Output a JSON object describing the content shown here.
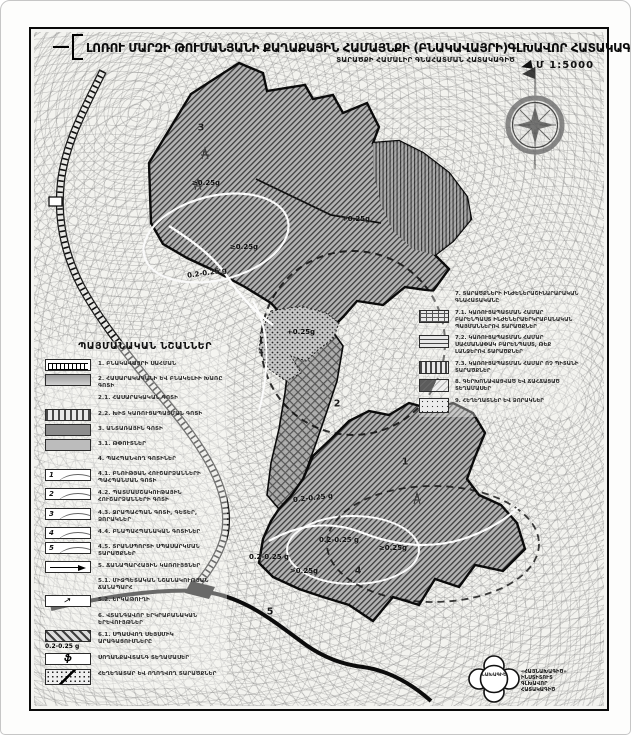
{
  "document": {
    "title": "ԼՈՌՈՒ ՄԱՐԶԻ ԹՈՒՄԱՆՅԱՆԻ ՔԱՂԱՔԱՅԻՆ ՀԱՄԱՅՆՔԻ (ԲՆԱԿԱՎԱՅՐԻ)ԳԼԽԱՎՈՐ ՀԱՏԱԿԱԳԻԾ",
    "subtitle": "ՏԱՐԱԾՔԻ ՀԱՄԱԼԻՐ ԳՆԱՀԱՏՄԱՆ ՀԱՏԱԿԱԳԻԾ",
    "scale_label": "Մ 1:5000"
  },
  "legend": {
    "title": "ՊԱՅՄԱՆԱԿԱՆ ՆՇԱՆՆԵՐ",
    "items": [
      {
        "label": "1. ԲՆԱԿԱՎԱՅՐԻ ՍԱՀՄԱՆ"
      },
      {
        "label": "2. ՀԱՍԱՐԱԿԱԿԱՆԻ ԵՎ ԲՆԱԿԵԼԻԻ ԽԱՌԸ ԳՈՏԻ"
      },
      {
        "label": "2.1. ՀԱՍԱՐԱԿԱԿԱՆ ԳՈՏԻ"
      },
      {
        "label": "2.2. ԽԻՏ ԿԱՌՈՒՑԱՊԱՏՄԱՆ ԳՈՏԻ"
      },
      {
        "label": "3. ԱՆՏԱՌԱՅԻՆ ԳՈՏԻ"
      },
      {
        "label": "3.1. ԹՓՈՒՏՆԵՐ"
      },
      {
        "label": "4. ՊԱՀՊԱՆՎՈՂ ԳՈՏԻՆԵՐ"
      },
      {
        "box": "1",
        "label": "4.1. ԲՆՈՒԹՅԱՆ ՀՈՒՇԱՐՁԱՆՆԵՐԻ ՊԱՀՊԱՆՄԱՆ ԳՈՏԻ"
      },
      {
        "box": "2",
        "label": "4.2. ՊԱՏՄԱՄՇԱԿՈՒԹԱՅԻՆ ՀՈՒՇԱՐՁԱՆՆԵՐԻ ԳՈՏԻ"
      },
      {
        "box": "3",
        "label": "4.3. ՋՐԱՊԱՀՊԱՆ ԳՈՏԻ, ԳԵՏԵՐ, ՁՈՐԱԿՆԵՐ"
      },
      {
        "box": "4",
        "label": "4.4. ԲՆԱՊԱՀՊԱՆԱԿԱՆ ԳՈՏԻՆԵՐ"
      },
      {
        "box": "5",
        "label": "4.5. ՏՐԱՆՍՊՈՐՏԻ ՍՊԱՍԱՐԿՄԱՆ ՏԱՐԱԾՔՆԵՐ"
      },
      {
        "label": "5. ՃԱՆԱՊԱՐՀԱՅԻՆ ԿԱՌՈՒՅՑՆԵՐ"
      },
      {
        "label": "5.1. ՄԻՋՊԵՏԱԿԱՆ ՆՇԱՆԱԿՈՒԹՅԱՆ ՃԱՆԱՊԱՐՀ"
      },
      {
        "label": "5.2. ԵՐԿԱԹՈՒՂԻ"
      },
      {
        "label": "6. ՎՏԱՆԳԱՎՈՐ ԵՐԿՐԱԲԱՆԱԿԱՆ ԵՐԵՎՈՒՅԹՆԵՐ"
      },
      {
        "label": "6.1. ՍՊԱՍՎՈՂ ՍԵՅՍՄԻԿ ԱՐԱԳԱՑՈՒՄՆԵՐԸ",
        "caption": "0.2-0.25 g"
      },
      {
        "box": "ֆ",
        "label": "ՍՈՂԱՆՔԱՎՏԱՆԳ ՏԵՂԱՄԱՍԵՐ"
      },
      {
        "label": "ՀԵՂԵՂԱՏԱՐ ԵՎ ՈՂՈՂՎՈՂ ՏԱՐԱԾՔՆԵՐ"
      }
    ]
  },
  "right_panel": {
    "items": [
      {
        "label": "7. ՏԱՐԱԾՔՆԵՐԻ ԻՆԺԵՆԵՐԱՇԻՆԱՐԱՐԱԿԱՆ ԳՆԱՀԱՏԱԿԱՆԸ"
      },
      {
        "label": "7.1. ԿԱՌՈՒՑԱՊԱՏՄԱՆ ՀԱՄԱՐ ԲԱՐԵՆՊԱՍՏ ԻՆԺԵՆԵՐԱԵՐԿՐԱԲԱՆԱԿԱՆ ՊԱՅՄԱՆՆԵՐՈՎ ՏԱՐԱԾՔՆԵՐ"
      },
      {
        "label": "7.2. ԿԱՌՈՒՑԱՊԱՏՄԱՆ ՀԱՄԱՐ ՍԱՀՄԱՆԱՓԱԿ ԲԱՐԵՆՊԱՍՏ, ԹԵՔ ԼԱՆՋԵՐՈՎ ՏԱՐԱԾՔՆԵՐ"
      },
      {
        "label": "7.3. ԿԱՌՈՒՑԱՊԱՏՄԱՆ ՀԱՄԱՐ ՈՉ ՊԻՏԱՆԻ ՏԱՐԱԾՔՆԵՐ"
      },
      {
        "label": "8. ԳԵՐԽՈՆԱՎԱՑՎԱԾ ԵՎ ՃԱՀՃԱՑԱԾ ՏԵՂԱՄԱՍԵՐ"
      },
      {
        "label": "9. ՀԵՂԵՂԱՏՆԵՐ ԵՎ ՁՈՐԱԿՆԵՐ"
      }
    ]
  },
  "map": {
    "labels": [
      {
        "text": "≥0.25g"
      },
      {
        "text": "+0.25g"
      },
      {
        "text": "≥0.25g"
      },
      {
        "text": "0.2-0.25 g"
      },
      {
        "text": "+0.25g"
      },
      {
        "text": "0.2-0.25 g"
      },
      {
        "text": "0.2-0.25 g"
      },
      {
        "text": "≥0.25g"
      },
      {
        "text": "0.2-0.25 g"
      },
      {
        "text": ">0.25g"
      }
    ],
    "zones": [
      {
        "num": "1"
      },
      {
        "num": "2"
      },
      {
        "num": "3"
      },
      {
        "num": "4"
      },
      {
        "num": "5"
      }
    ]
  },
  "stamp": {
    "center_text": "ՆԱԽԱԳԻԾ",
    "side_line1": "«ՀԱՅՆԱԽԱԳԻԾ» ԻՆՍՏԻՏՈՒՏ",
    "side_line2": "ԳԼԽԱՎՈՐ ՀԱՏԱԿԱԳԻԾ"
  }
}
